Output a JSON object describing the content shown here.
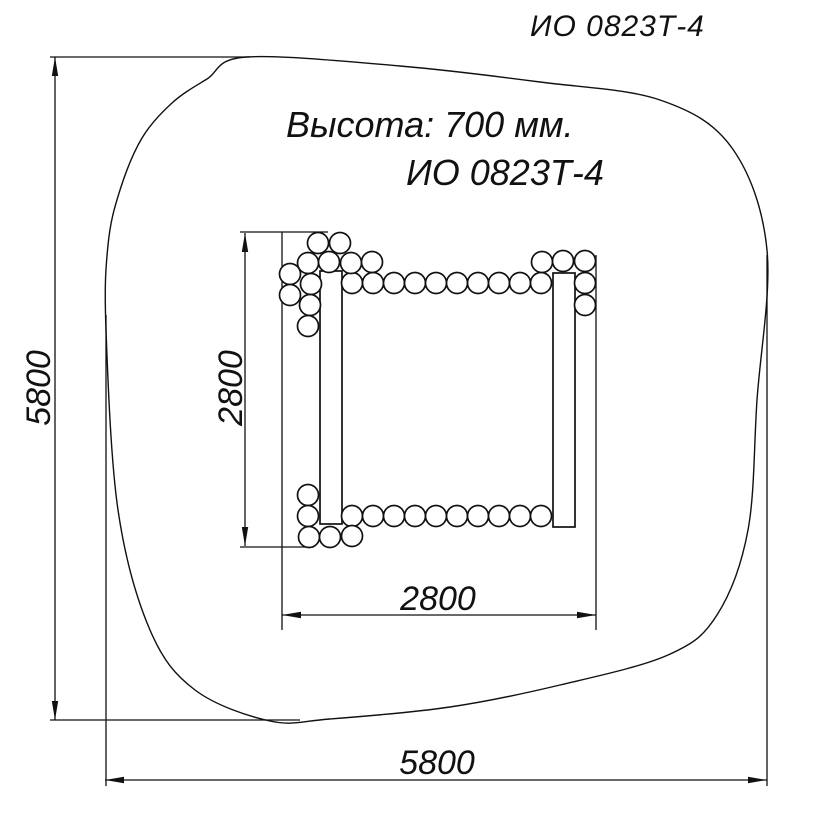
{
  "page": {
    "title": "ИО 0823Т-4",
    "height_note": "Высота: 700 мм.",
    "model_label": "ИО 0823Т-4"
  },
  "colors": {
    "ink": "#111111",
    "background": "#ffffff"
  },
  "drawing": {
    "safety_zone": {
      "name": "safety-zone-outline",
      "points": [
        [
          247,
          57
        ],
        [
          400,
          66
        ],
        [
          540,
          82
        ],
        [
          660,
          100
        ],
        [
          732,
          148
        ],
        [
          767,
          250
        ],
        [
          757,
          400
        ],
        [
          748,
          530
        ],
        [
          717,
          615
        ],
        [
          668,
          655
        ],
        [
          560,
          685
        ],
        [
          450,
          707
        ],
        [
          330,
          719
        ],
        [
          270,
          721
        ],
        [
          195,
          690
        ],
        [
          150,
          630
        ],
        [
          118,
          510
        ],
        [
          106,
          330
        ],
        [
          108,
          245
        ],
        [
          120,
          190
        ],
        [
          142,
          138
        ],
        [
          172,
          103
        ],
        [
          207,
          79
        ]
      ]
    },
    "posts": [
      {
        "name": "left-post",
        "x": 320,
        "y": 271,
        "w": 22,
        "h": 253
      },
      {
        "name": "right-post",
        "x": 553,
        "y": 273,
        "w": 22,
        "h": 254
      }
    ],
    "ball_radius": 10.5,
    "balls": [
      [
        352,
        283
      ],
      [
        373,
        283
      ],
      [
        394,
        283
      ],
      [
        415,
        283
      ],
      [
        436,
        283
      ],
      [
        457,
        283
      ],
      [
        478,
        283
      ],
      [
        499,
        283
      ],
      [
        520,
        283
      ],
      [
        541,
        283
      ],
      [
        352,
        516
      ],
      [
        373,
        516
      ],
      [
        394,
        516
      ],
      [
        415,
        516
      ],
      [
        436,
        516
      ],
      [
        457,
        516
      ],
      [
        478,
        516
      ],
      [
        499,
        516
      ],
      [
        520,
        516
      ],
      [
        541,
        516
      ],
      [
        318,
        243
      ],
      [
        340,
        243
      ],
      [
        308,
        263
      ],
      [
        329,
        262
      ],
      [
        351,
        263
      ],
      [
        372,
        262
      ],
      [
        290,
        274
      ],
      [
        290,
        295
      ],
      [
        311,
        284
      ],
      [
        310,
        305
      ],
      [
        308,
        326
      ],
      [
        542,
        262
      ],
      [
        563,
        261
      ],
      [
        585,
        261
      ],
      [
        585,
        283
      ],
      [
        585,
        305
      ],
      [
        308,
        495
      ],
      [
        308,
        516
      ],
      [
        309,
        537
      ],
      [
        330,
        537
      ],
      [
        352,
        536
      ]
    ],
    "dimensions": [
      {
        "name": "zone-height",
        "label": "5800",
        "orientation": "v",
        "line": {
          "x": 55,
          "from": 57,
          "to": 720
        },
        "extensions": [
          {
            "x1": 50,
            "y1": 57,
            "x2": 250,
            "y2": 57
          },
          {
            "x1": 50,
            "y1": 720,
            "x2": 300,
            "y2": 720
          }
        ],
        "label_pos": {
          "x": 50,
          "y": 388,
          "rotate": -90
        }
      },
      {
        "name": "zone-width",
        "label": "5800",
        "orientation": "h",
        "line": {
          "y": 780,
          "from": 105,
          "to": 767
        },
        "extensions": [
          {
            "x1": 106,
            "y1": 315,
            "x2": 106,
            "y2": 786
          },
          {
            "x1": 767,
            "y1": 255,
            "x2": 767,
            "y2": 786
          }
        ],
        "label_pos": {
          "x": 437,
          "y": 774,
          "rotate": 0
        }
      },
      {
        "name": "frame-height",
        "label": "2800",
        "orientation": "v",
        "line": {
          "x": 245,
          "from": 233,
          "to": 546
        },
        "extensions": [
          {
            "x1": 240,
            "y1": 232,
            "x2": 328,
            "y2": 232
          },
          {
            "x1": 240,
            "y1": 547,
            "x2": 314,
            "y2": 547
          }
        ],
        "label_pos": {
          "x": 242,
          "y": 388,
          "rotate": -90
        }
      },
      {
        "name": "frame-width",
        "label": "2800",
        "orientation": "h",
        "line": {
          "y": 615,
          "from": 282,
          "to": 596
        },
        "extensions": [
          {
            "x1": 282,
            "y1": 232,
            "x2": 282,
            "y2": 630
          },
          {
            "x1": 596,
            "y1": 255,
            "x2": 596,
            "y2": 630
          }
        ],
        "label_pos": {
          "x": 438,
          "y": 610,
          "rotate": 0
        }
      }
    ]
  }
}
